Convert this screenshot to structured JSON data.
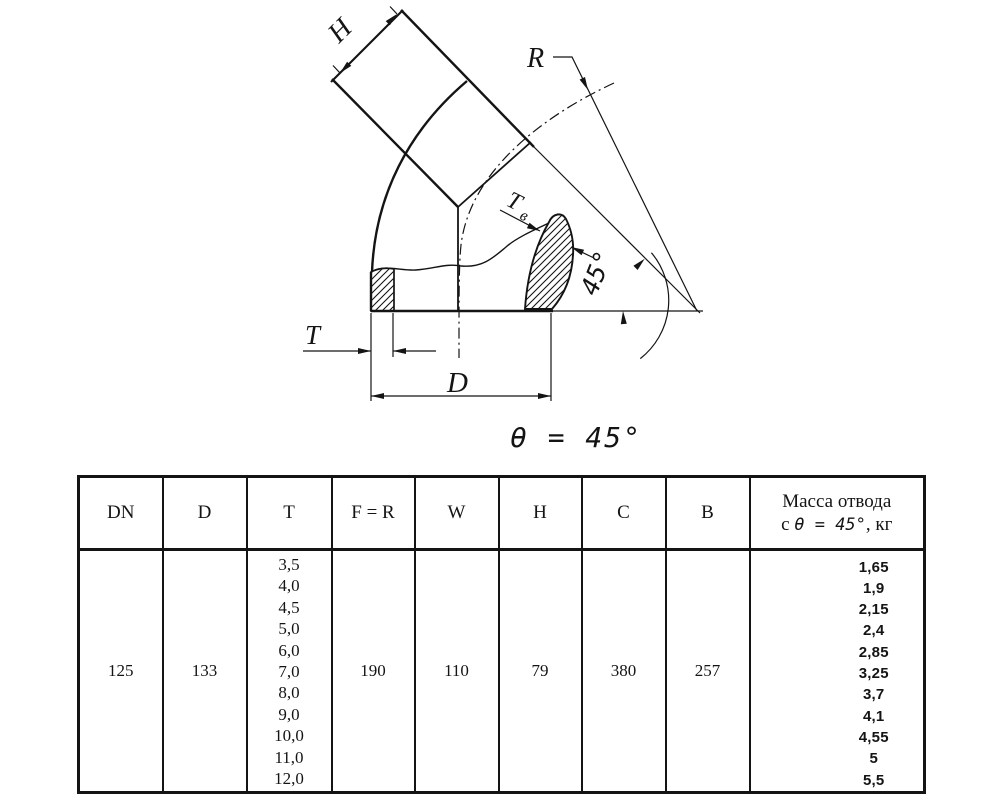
{
  "drawing": {
    "dim_h": "H",
    "dim_r": "R",
    "dim_tw_main": "T",
    "dim_tw_sub": "в",
    "angle_arc_label": "45°",
    "dim_t": "T",
    "dim_d": "D",
    "theta_label": "θ = 45°"
  },
  "table": {
    "headers": [
      "DN",
      "D",
      "T",
      "F = R",
      "W",
      "H",
      "C",
      "B"
    ],
    "mass_header": {
      "line1": "Масса отвода",
      "line2_prefix": "с ",
      "line2_italic": "θ = 45°",
      "line2_suffix": ", кг"
    },
    "row": {
      "dn": "125",
      "d": "133",
      "t_values": [
        "3,5",
        "4,0",
        "4,5",
        "5,0",
        "6,0",
        "7,0",
        "8,0",
        "9,0",
        "10,0",
        "11,0",
        "12,0"
      ],
      "f_r": "190",
      "w": "110",
      "h": "79",
      "c": "380",
      "b": "257",
      "mass_values": [
        "1,65",
        "1,9",
        "2,15",
        "2,4",
        "2,85",
        "3,25",
        "3,7",
        "4,1",
        "4,55",
        "5",
        "5,5"
      ]
    }
  }
}
